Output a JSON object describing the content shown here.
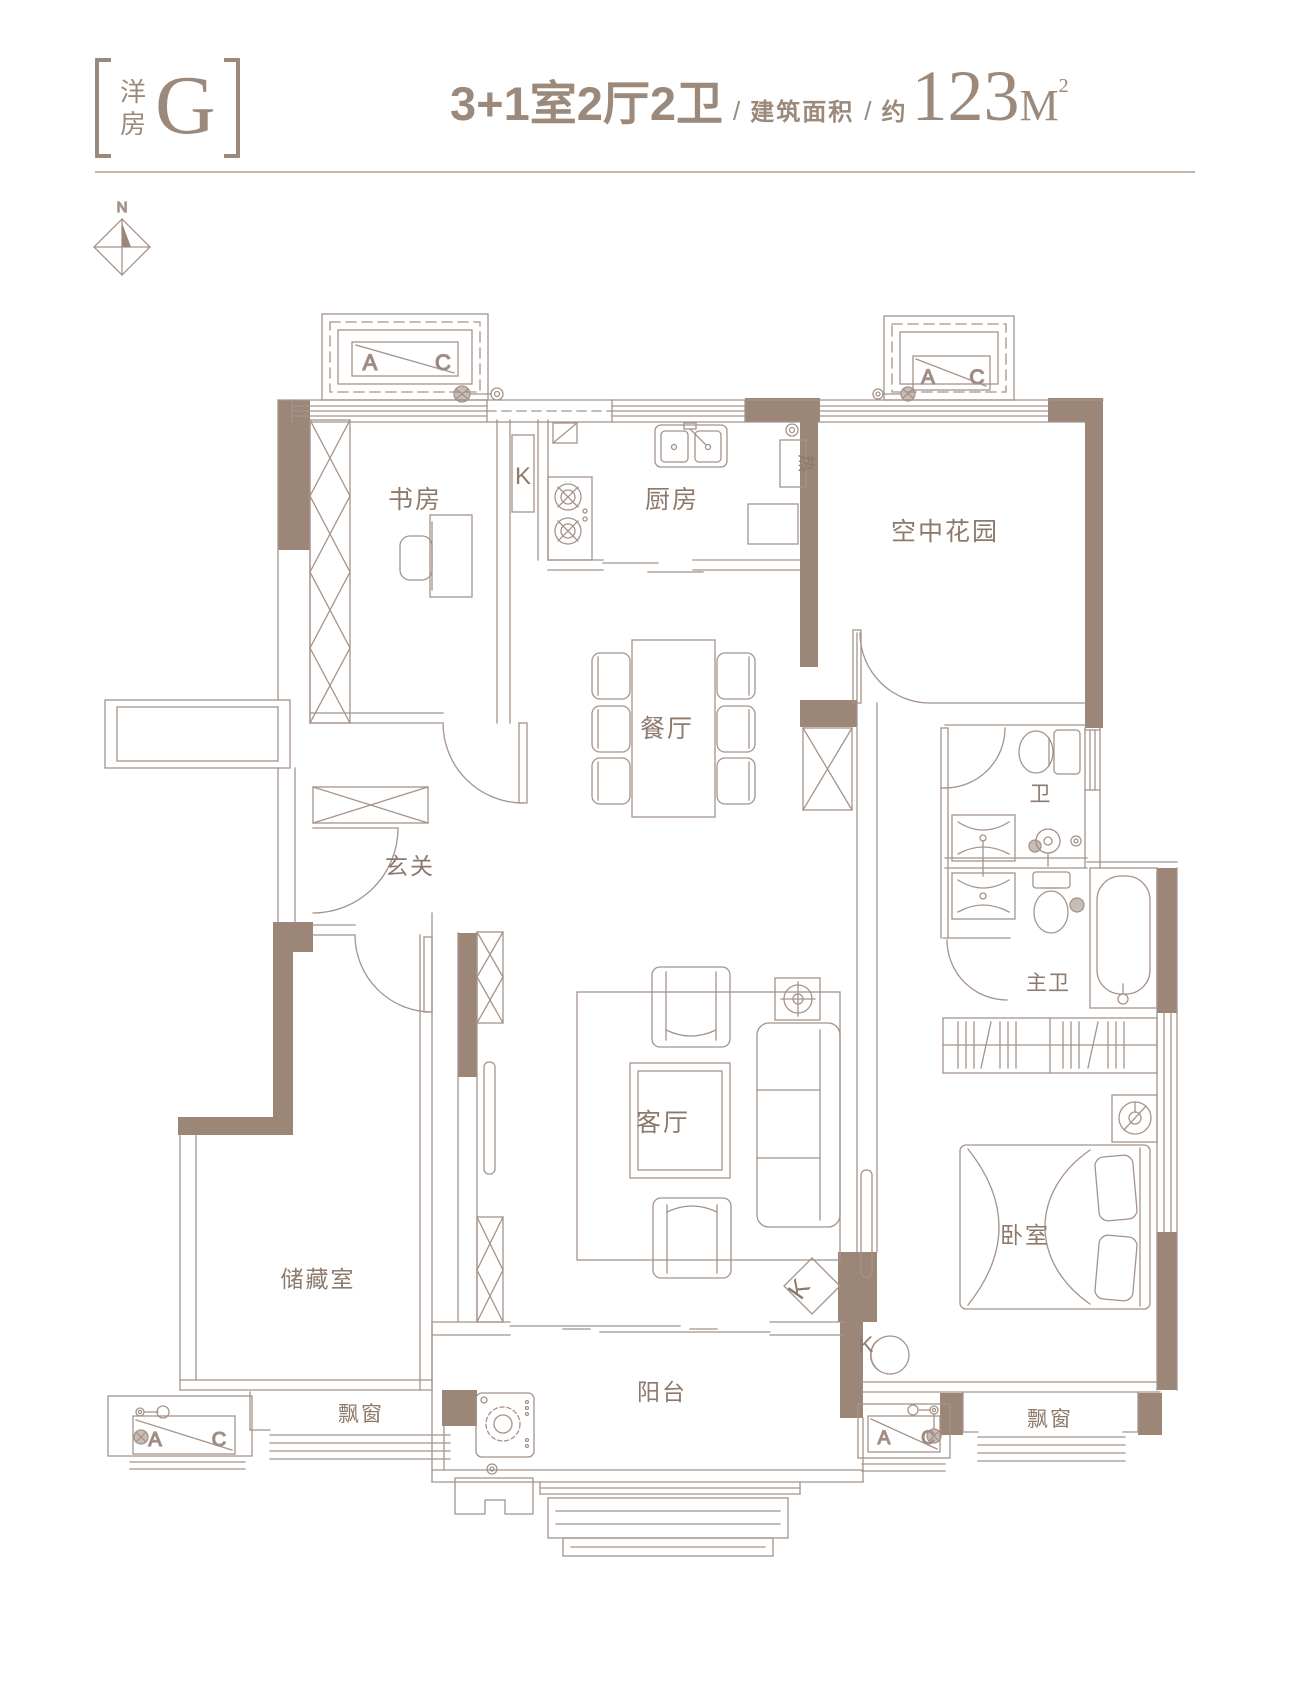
{
  "header": {
    "unit_type": "洋房",
    "unit_letter": "G",
    "spec": "3+1室2厅2卫",
    "sep1": "/",
    "area_label": "建筑面积",
    "sep2": "/",
    "approx": "约",
    "area_value": "123",
    "area_unit": "M",
    "area_exp": "2"
  },
  "compass": {
    "north": "N"
  },
  "plan": {
    "rooms": {
      "study": "书房",
      "kitchen": "厨房",
      "sky_garden": "空中花园",
      "dining": "餐厅",
      "foyer": "玄关",
      "bath": "卫",
      "master_bath": "主卫",
      "living": "客厅",
      "storage": "储藏室",
      "bedroom": "卧室",
      "balcony": "阳台",
      "bay_window_left": "飘窗",
      "bay_window_right": "飘窗",
      "water_heater": "热"
    },
    "markers": {
      "ac_a": "A",
      "ac_c": "C",
      "k": "K"
    }
  },
  "colors": {
    "accent": "#9b8a7c",
    "wall_fill": "#9b8678",
    "line": "#a5938a",
    "label_text": "#8d7a6c"
  }
}
